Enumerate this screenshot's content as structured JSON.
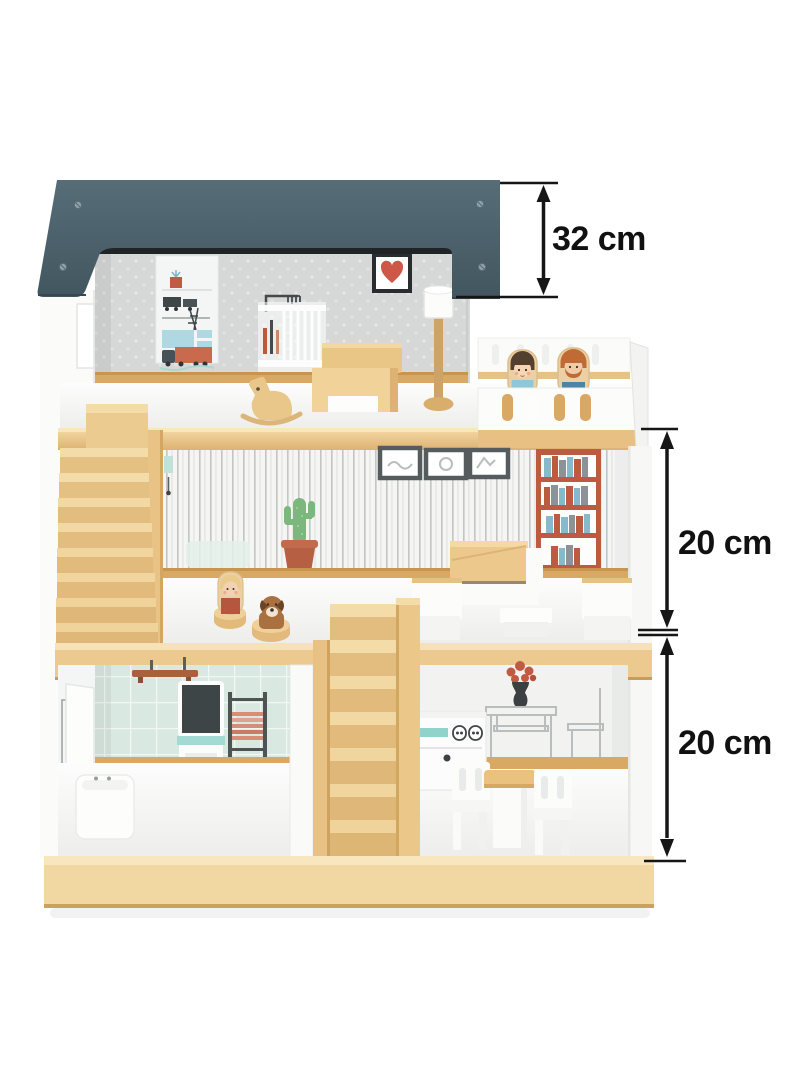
{
  "scene": {
    "description": "Product photo of a three-storey wooden dollhouse with furniture, peg dolls and black dimension arrows",
    "background_color": "#ffffff"
  },
  "annotations": {
    "line_color": "#161616",
    "dimensions": [
      {
        "id": "roof-section-height",
        "label": "32 cm",
        "value_cm": 32
      },
      {
        "id": "upper-floor-height",
        "label": "20 cm",
        "value_cm": 20
      },
      {
        "id": "ground-floor-height",
        "label": "20 cm",
        "value_cm": 20
      }
    ]
  },
  "palette": {
    "roof_slate": "#4b6370",
    "wood_light": "#f3d9a6",
    "wood_mid": "#e5c083",
    "wood_dark": "#c79d5e",
    "wallpaper_top": "#d6d8d7",
    "wallpaper_stripe_bg": "#f5f5f3",
    "tile_mint": "#d9e8e0",
    "accent_red": "#c75a44",
    "accent_teal": "#8fd3cb",
    "doll_shirt_blue": "#4a84a8",
    "doll_top_lightblue": "#8ec7d8",
    "white": "#fdfdfd"
  },
  "house": {
    "floors": [
      {
        "name": "attic bedroom",
        "items": [
          "nursery wall poster",
          "heart picture",
          "crib wall print",
          "wooden bed",
          "rocking horse",
          "floor lamp",
          "balcony with woman and man peg dolls"
        ]
      },
      {
        "name": "living room",
        "items": [
          "staircase to attic",
          "three picture frames",
          "bookshelf wall print",
          "cactus in pot",
          "wooden sofa",
          "two white armchairs",
          "coffee table",
          "girl peg doll",
          "dog figure"
        ]
      },
      {
        "name": "ground floor",
        "items": [
          "bathroom with washing-machine print, towel shelf, chalkboard washstand, towel ladder and bathtub",
          "central staircase",
          "kitchen with vase, table and chair wall prints, stove unit, dining table and two chairs"
        ]
      }
    ]
  }
}
